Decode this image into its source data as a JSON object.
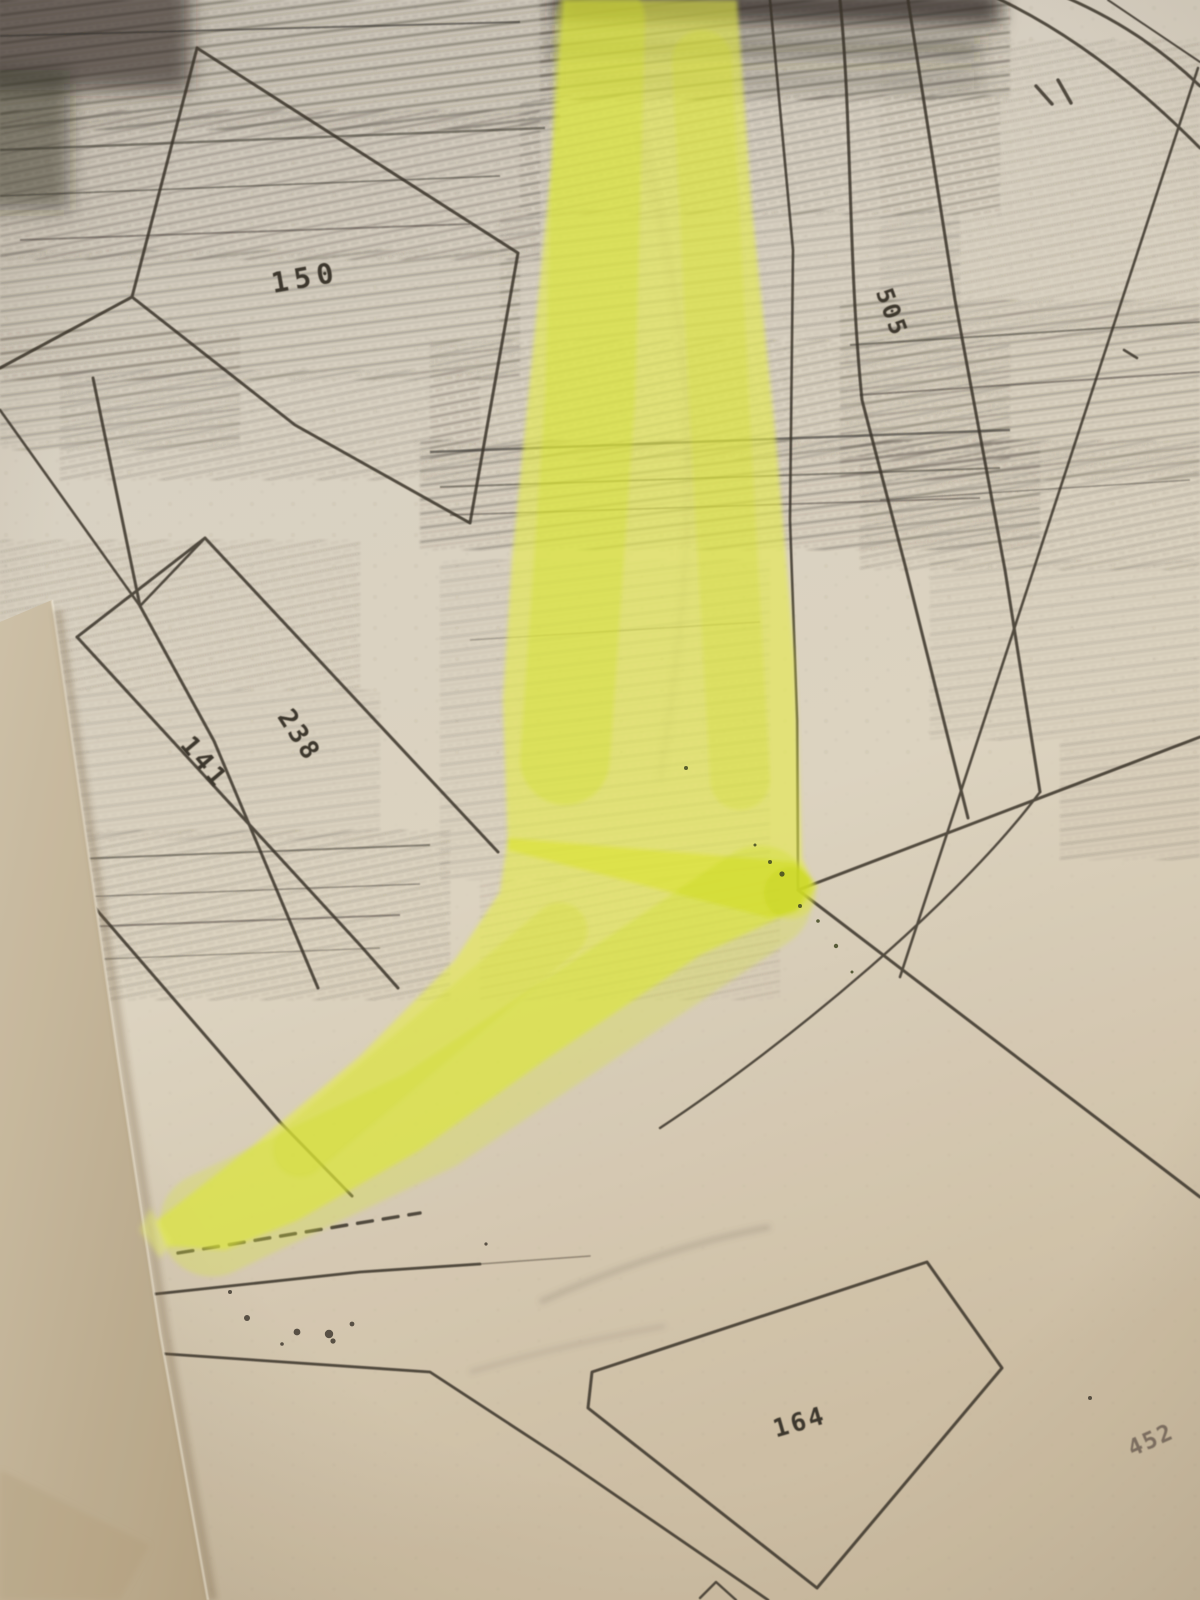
{
  "map": {
    "description_labels": {
      "parcel_150": "150",
      "parcel_238": "238",
      "parcel_141": "141",
      "parcel_505": "505",
      "parcel_164": "164",
      "parcel_452": "452"
    },
    "colors": {
      "highlighter": "#e8f044",
      "map_line": "#2f2a24",
      "paper": "#d9d2c4",
      "page_edge_tan": "#c3b498"
    }
  }
}
